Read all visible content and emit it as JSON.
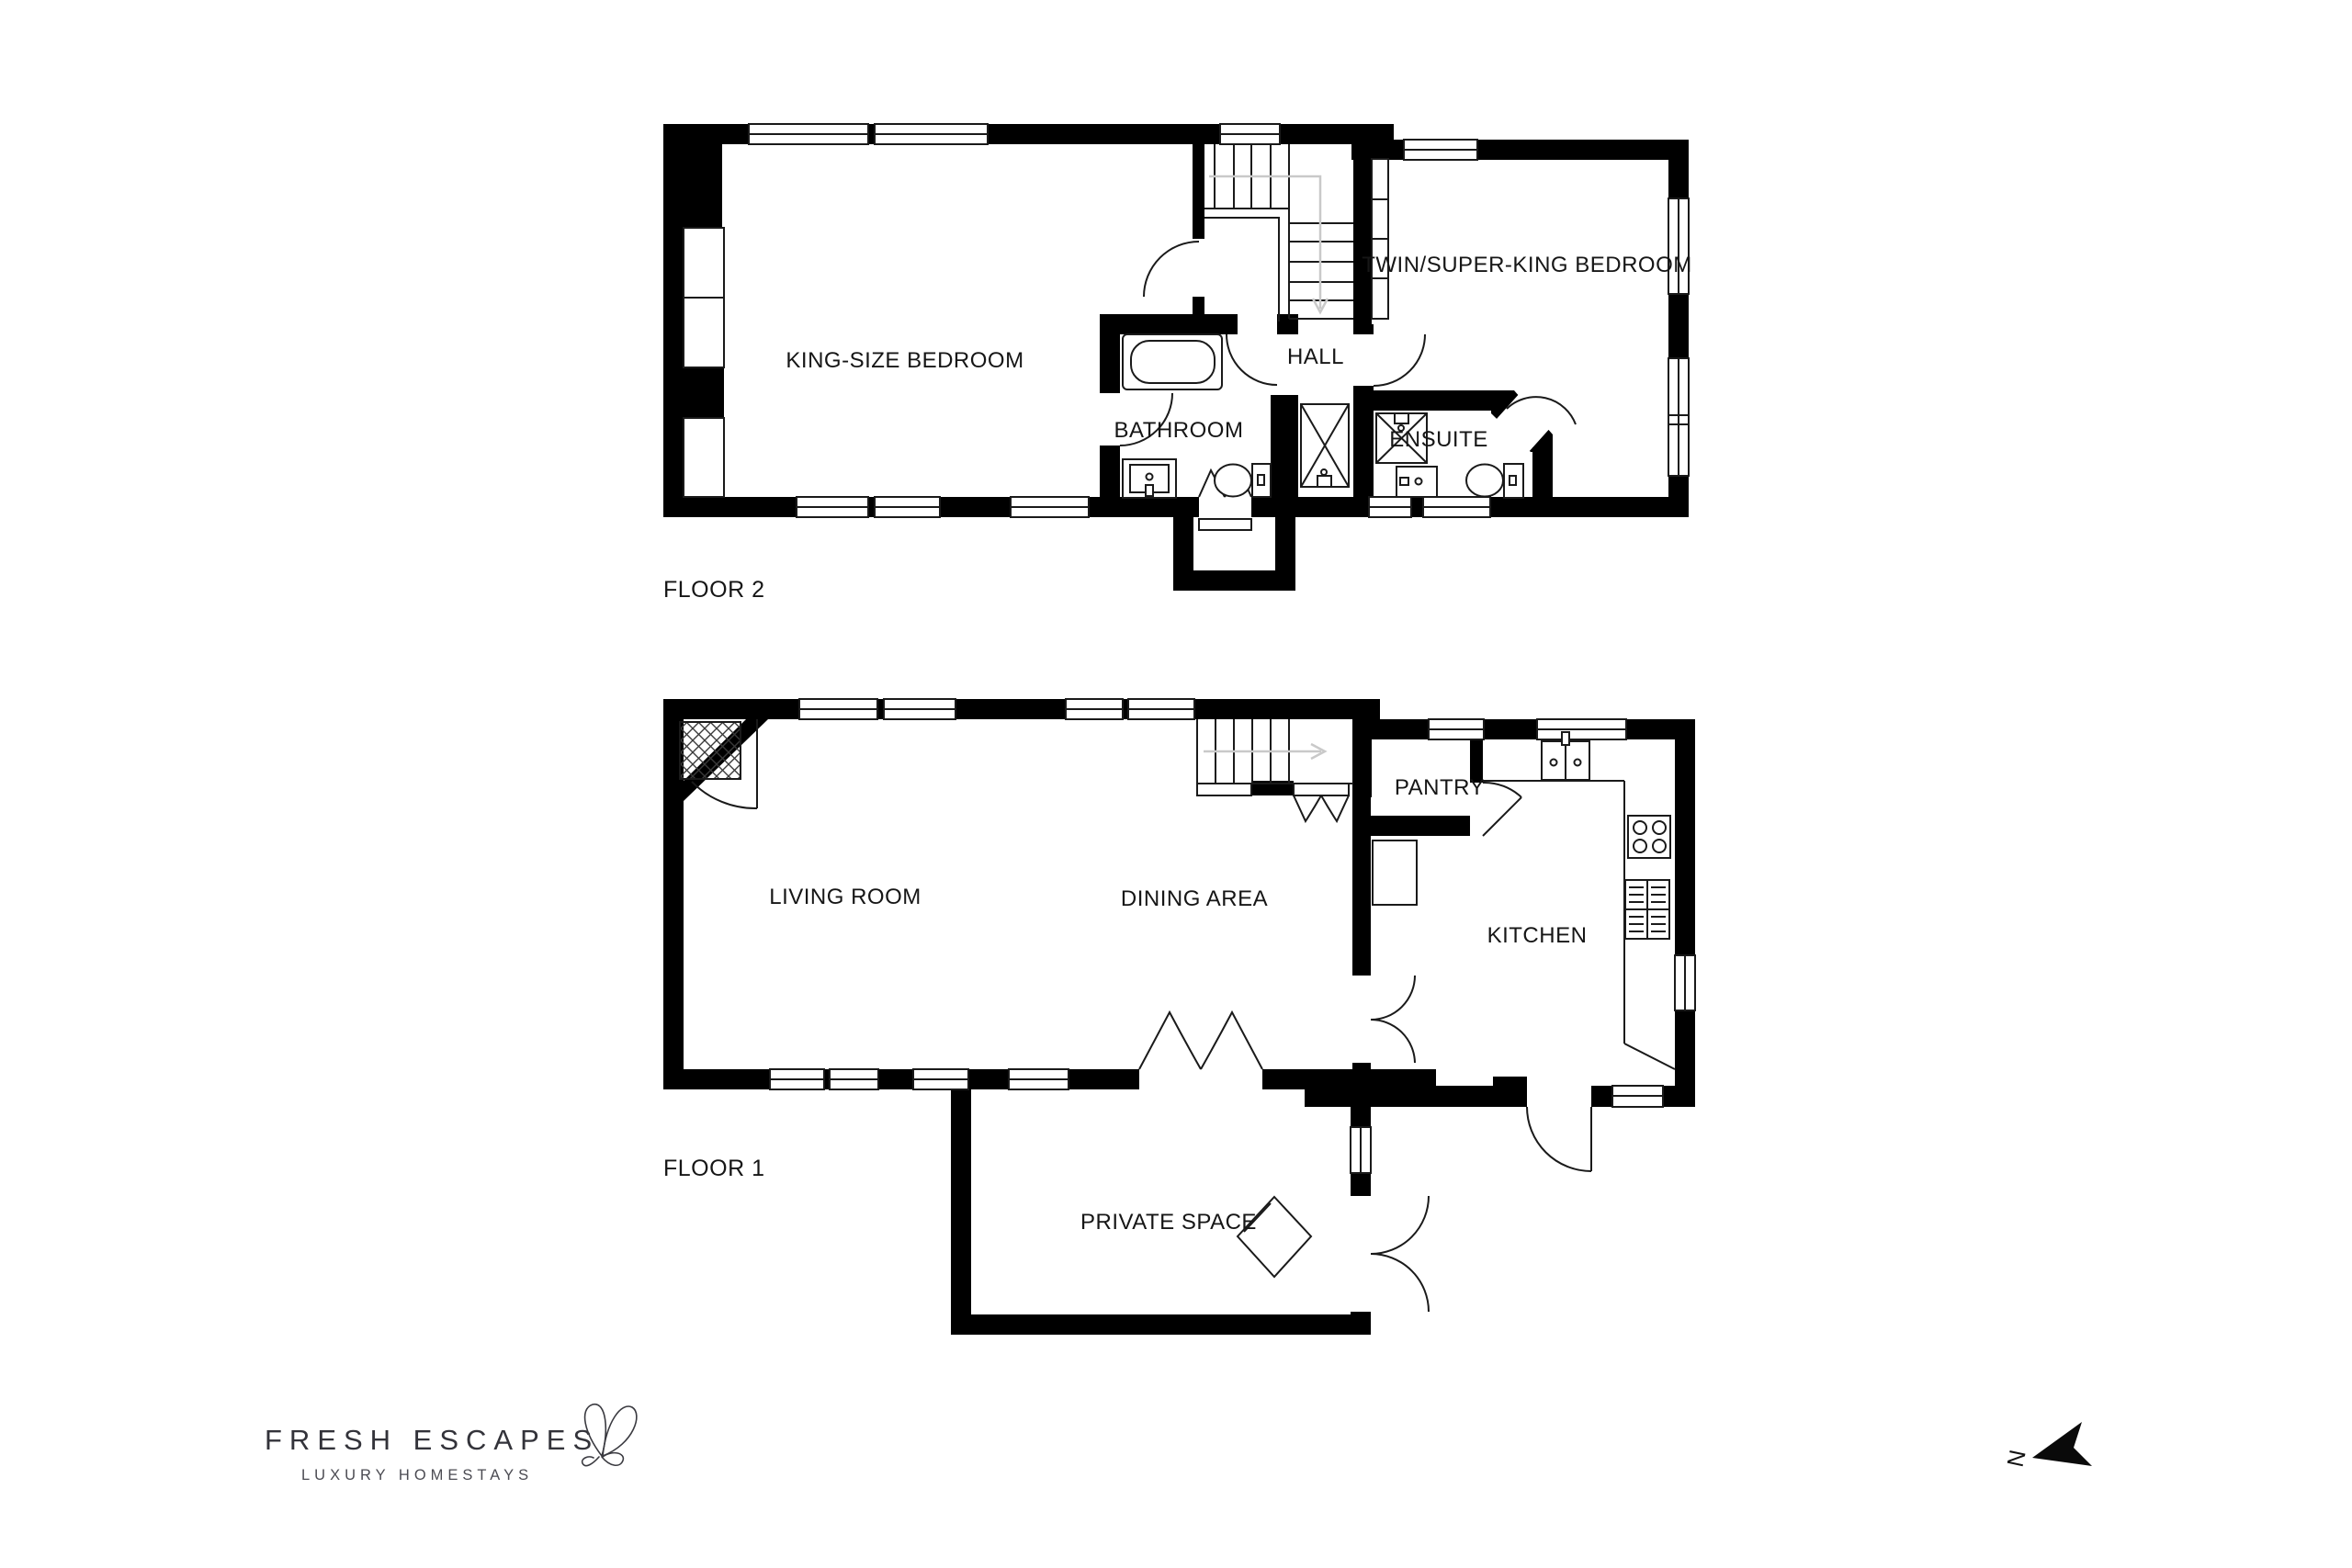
{
  "document": {
    "type": "property floor plan",
    "floors_shown": 2
  },
  "floor2": {
    "label": "FLOOR 2",
    "rooms": {
      "king": "KING-SIZE BEDROOM",
      "hall": "HALL",
      "bathroom": "BATHROOM",
      "ensuite": "ENSUITE",
      "twin": "TWIN/SUPER-KING BEDROOM"
    }
  },
  "floor1": {
    "label": "FLOOR 1",
    "rooms": {
      "living": "LIVING ROOM",
      "dining": "DINING AREA",
      "pantry": "PANTRY",
      "kitchen": "KITCHEN",
      "private": "PRIVATE SPACE"
    }
  },
  "brand": {
    "name": "FRESH ESCAPES",
    "tagline": "LUXURY HOMESTAYS"
  },
  "compass": {
    "north_label": "N"
  },
  "colors": {
    "wall": "#000000",
    "line": "#1a1a1a",
    "guide_arrow": "#c9c9c9",
    "background": "#ffffff",
    "brand_text": "#33333a"
  }
}
